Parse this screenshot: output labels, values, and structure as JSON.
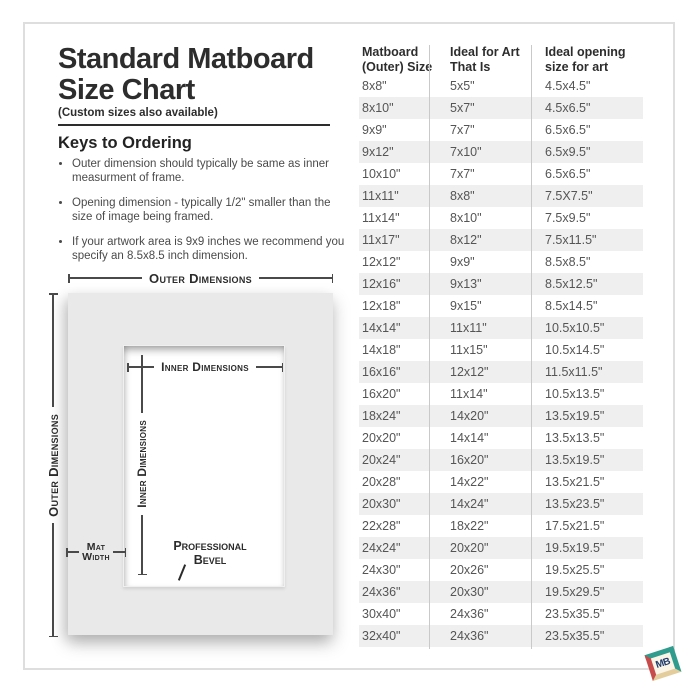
{
  "page": {
    "title_line1": "Standard Matboard",
    "title_line2": "Size Chart",
    "subtitle": "(Custom sizes also available)",
    "keys_heading": "Keys to Ordering",
    "bullets": [
      "Outer dimension should typically be same as inner measurment of frame.",
      "Opening dimension - typically 1/2\" smaller than the size of image being framed.",
      "If your artwork area is 9x9 inches we recommend you specify an 8.5x8.5 inch dimension."
    ]
  },
  "diagram": {
    "outer_dimensions_top": "Outer Dimensions",
    "outer_dimensions_left": "Outer Dimensions",
    "inner_dimensions_top": "Inner Dimensions",
    "inner_dimensions_left": "Inner Dimensions",
    "mat_width_line1": "Mat",
    "mat_width_line2": "Width",
    "bevel_line1": "Professional",
    "bevel_line2": "Bevel"
  },
  "table": {
    "headers": [
      {
        "line1": "Matboard",
        "line2": "(Outer) Size"
      },
      {
        "line1": "Ideal for Art",
        "line2": "That Is"
      },
      {
        "line1": "Ideal opening",
        "line2": "size for art"
      }
    ],
    "rows": [
      [
        "8x8\"",
        "5x5\"",
        "4.5x4.5\""
      ],
      [
        "8x10\"",
        "5x7\"",
        "4.5x6.5\""
      ],
      [
        "9x9\"",
        "7x7\"",
        "6.5x6.5\""
      ],
      [
        "9x12\"",
        "7x10\"",
        "6.5x9.5\""
      ],
      [
        "10x10\"",
        "7x7\"",
        "6.5x6.5\""
      ],
      [
        "11x11\"",
        "8x8\"",
        "7.5X7.5\""
      ],
      [
        "11x14\"",
        "8x10\"",
        "7.5x9.5\""
      ],
      [
        "11x17\"",
        "8x12\"",
        "7.5x11.5\""
      ],
      [
        "12x12\"",
        "9x9\"",
        "8.5x8.5\""
      ],
      [
        "12x16\"",
        "9x13\"",
        "8.5x12.5\""
      ],
      [
        "12x18\"",
        "9x15\"",
        "8.5x14.5\""
      ],
      [
        "14x14\"",
        "11x11\"",
        "10.5x10.5\""
      ],
      [
        "14x18\"",
        "11x15\"",
        "10.5x14.5\""
      ],
      [
        "16x16\"",
        "12x12\"",
        "11.5x11.5\""
      ],
      [
        "16x20\"",
        "11x14\"",
        "10.5x13.5\""
      ],
      [
        "18x24\"",
        "14x20\"",
        "13.5x19.5\""
      ],
      [
        "20x20\"",
        "14x14\"",
        "13.5x13.5\""
      ],
      [
        "20x24\"",
        "16x20\"",
        "13.5x19.5\""
      ],
      [
        "20x28\"",
        "14x22\"",
        "13.5x21.5\""
      ],
      [
        "20x30\"",
        "14x24\"",
        "13.5x23.5\""
      ],
      [
        "22x28\"",
        "18x22\"",
        "17.5x21.5\""
      ],
      [
        "24x24\"",
        "20x20\"",
        "19.5x19.5\""
      ],
      [
        "24x30\"",
        "20x26\"",
        "19.5x25.5\""
      ],
      [
        "24x36\"",
        "20x30\"",
        "19.5x29.5\""
      ],
      [
        "30x40\"",
        "24x36\"",
        "23.5x35.5\""
      ],
      [
        "32x40\"",
        "24x36\"",
        "23.5x35.5\""
      ]
    ]
  },
  "logo": {
    "text": "MB"
  },
  "colors": {
    "heading_text": "#2d2d2d",
    "body_text": "#4a4a4a",
    "cell_text": "#555555",
    "alt_row_bg": "#efefef",
    "separator": "#c9c9c9",
    "mat_gray": "#e9e9e9",
    "logo_teal": "#2f9c8e",
    "logo_red": "#c84b4b",
    "logo_cream": "#e4cd9c",
    "logo_navy": "#1e3a6e"
  }
}
